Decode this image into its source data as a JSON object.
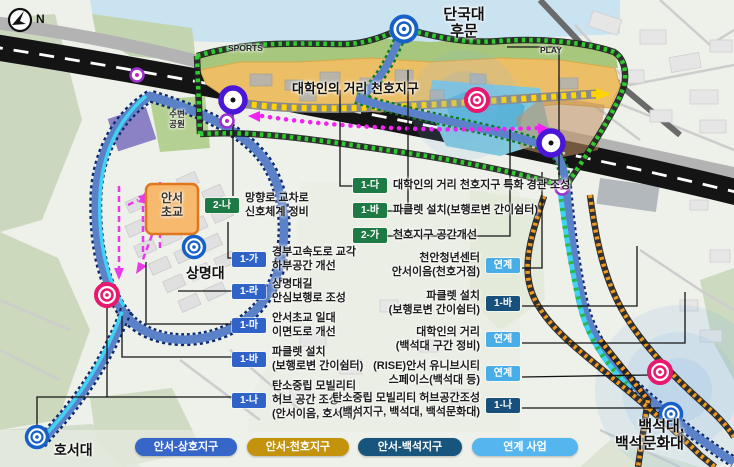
{
  "compass": {
    "label": "N"
  },
  "map_labels": {
    "dankook": {
      "line1": "단국대",
      "line2": "후문"
    },
    "sports": "SPORTS",
    "play": "PLAY",
    "cheonho_district": "대학인의 거리 천호지구",
    "waterside_park": {
      "line1": "수변",
      "line2": "공원"
    },
    "anseo_elementary": {
      "line1": "안서",
      "line2": "초교"
    },
    "sangmyung": "상명대",
    "hoseo": "호서대",
    "baekseok": {
      "line1": "백석대,",
      "line2": "백석문화대"
    }
  },
  "callouts": {
    "left": [
      {
        "code": "2-나",
        "line1": "망향로 교차로",
        "line2": "신호체계 정비"
      },
      {
        "code": "1-가",
        "line1": "경부고속도로 교각",
        "line2": "하부공간 개선"
      },
      {
        "code": "1-라",
        "line1": "상명대길",
        "line2": "안심보행로 조성"
      },
      {
        "code": "1-마",
        "line1": "안서초교 일대",
        "line2": "이면도로 개선"
      },
      {
        "code": "1-바",
        "line1": "파클렛 설치",
        "line2": "(보행로변 간이쉼터)"
      },
      {
        "code": "1-나",
        "line1": "탄소중립 모빌리티",
        "line2": "허브 공간 조성",
        "line3": "(안서이음, 호서대)"
      }
    ],
    "middle": [
      {
        "code": "1-다",
        "text": "대학인의 거리 천호지구 특화 경관 조성"
      },
      {
        "code": "1-바",
        "text": "파클렛 설치(보행로변 간이쉼터)"
      },
      {
        "code": "2-가",
        "text": "천호지구 공간개선"
      }
    ],
    "right": [
      {
        "code": "연계",
        "line1": "천안청년센터",
        "line2": "안서이음(천호거점)"
      },
      {
        "code": "1-바",
        "line1": "파클렛 설치",
        "line2": "(보행로변 간이쉼터)"
      },
      {
        "code": "연계",
        "line1": "대학인의 거리",
        "line2": "(백석대 구간 정비)"
      },
      {
        "code": "연계",
        "line1": "(RISE)안서 유니브시티",
        "line2": "스페이스(백석대 등)"
      },
      {
        "code": "1-나",
        "line1": "탄소중립 모빌리티 허브공간조성",
        "line2": "(백석지구, 백석대, 백석문화대)"
      }
    ]
  },
  "legend": {
    "items": [
      {
        "label": "안서-상호지구",
        "color": "#3566c8"
      },
      {
        "label": "안서-천호지구",
        "color": "#c3930e"
      },
      {
        "label": "안서-백석지구",
        "color": "#17557c"
      },
      {
        "label": "연계 사업",
        "color": "#55b5ee"
      }
    ]
  },
  "colors": {
    "badge_blue": "#2f63c8",
    "badge_green": "#1e7a44",
    "badge_navy": "#17507a",
    "badge_sky": "#49aee8",
    "route_green": "#2ecc2e",
    "route_orange": "#f09a20",
    "route_magenta": "#f222f2",
    "road_blue": "#5b82c8",
    "stream_cyan": "#3fd2f2",
    "district_tan": "#ecbf67",
    "marker_blue": "#1660c8",
    "marker_pink": "#e8186e",
    "marker_purple": "#4a16d8"
  }
}
